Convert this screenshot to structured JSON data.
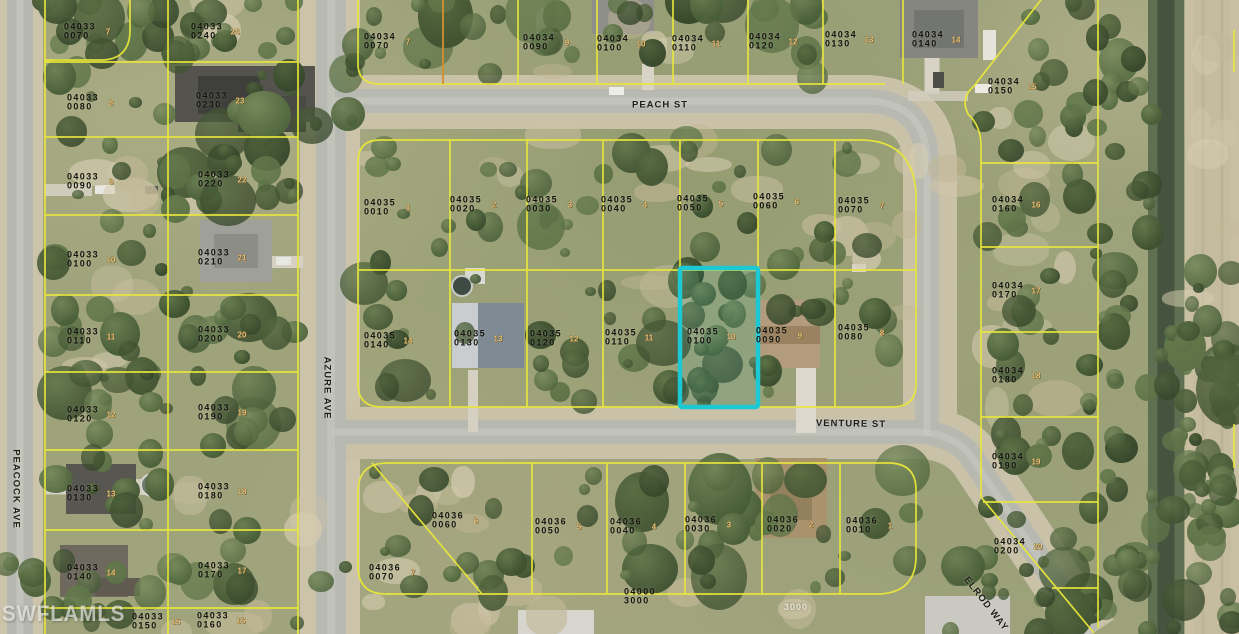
{
  "watermark": "SWFLAMLS",
  "colors": {
    "boundary": "#e9e73b",
    "boundary_alt": "#d78f2e",
    "highlight": "#1cc8d3",
    "parcel_text": "#14140c",
    "lot_text": "#ecc47e",
    "street_text": "#1f1f16"
  },
  "highlight": {
    "apn": "04035 0100",
    "x": 680,
    "y": 268,
    "w": 78,
    "h": 139
  },
  "streets": [
    {
      "name": "PEACH ST",
      "x": 660,
      "y": 105,
      "rotate": 0
    },
    {
      "name": "VENTURE ST",
      "x": 851,
      "y": 424,
      "rotate": 1
    },
    {
      "name": "AZURE AVE",
      "x": 327,
      "y": 388,
      "rotate": 90
    },
    {
      "name": "PEACOCK AVE",
      "x": 16,
      "y": 489,
      "rotate": 90
    },
    {
      "name": "ELROD WAY",
      "x": 986,
      "y": 604,
      "rotate": 52
    }
  ],
  "parcels": [
    {
      "apn": "04033 0070",
      "lot": "7",
      "x": 80,
      "y": 31
    },
    {
      "apn": "04033 0240",
      "lot": "24",
      "x": 207,
      "y": 31
    },
    {
      "apn": "04033 0080",
      "lot": "8",
      "x": 83,
      "y": 102
    },
    {
      "apn": "04033 0230",
      "lot": "23",
      "x": 212,
      "y": 100
    },
    {
      "apn": "04033 0090",
      "lot": "9",
      "x": 83,
      "y": 181
    },
    {
      "apn": "04033 0220",
      "lot": "22",
      "x": 214,
      "y": 179
    },
    {
      "apn": "04033 0100",
      "lot": "10",
      "x": 83,
      "y": 259
    },
    {
      "apn": "04033 0210",
      "lot": "21",
      "x": 214,
      "y": 257
    },
    {
      "apn": "04033 0110",
      "lot": "11",
      "x": 83,
      "y": 336
    },
    {
      "apn": "04033 0200",
      "lot": "20",
      "x": 214,
      "y": 334
    },
    {
      "apn": "04033 0120",
      "lot": "12",
      "x": 83,
      "y": 414
    },
    {
      "apn": "04033 0190",
      "lot": "19",
      "x": 214,
      "y": 412
    },
    {
      "apn": "04033 0130",
      "lot": "13",
      "x": 83,
      "y": 493
    },
    {
      "apn": "04033 0180",
      "lot": "18",
      "x": 214,
      "y": 491
    },
    {
      "apn": "04033 0140",
      "lot": "14",
      "x": 83,
      "y": 572
    },
    {
      "apn": "04033 0170",
      "lot": "17",
      "x": 214,
      "y": 570
    },
    {
      "apn": "04033 0150",
      "lot": "15",
      "x": 148,
      "y": 621
    },
    {
      "apn": "04033 0160",
      "lot": "16",
      "x": 213,
      "y": 620
    },
    {
      "apn": "04034 0070",
      "lot": "7",
      "x": 380,
      "y": 41
    },
    {
      "apn": "04034 0090",
      "lot": "9",
      "x": 539,
      "y": 42
    },
    {
      "apn": "04034 0100",
      "lot": "10",
      "x": 613,
      "y": 43
    },
    {
      "apn": "04034 0110",
      "lot": "11",
      "x": 688,
      "y": 43
    },
    {
      "apn": "04034 0120",
      "lot": "12",
      "x": 765,
      "y": 41
    },
    {
      "apn": "04034 0130",
      "lot": "13",
      "x": 841,
      "y": 39
    },
    {
      "apn": "04034 0140",
      "lot": "14",
      "x": 928,
      "y": 39
    },
    {
      "apn": "04034 0150",
      "lot": "15",
      "x": 1004,
      "y": 86
    },
    {
      "apn": "04034 0160",
      "lot": "16",
      "x": 1008,
      "y": 204
    },
    {
      "apn": "04034 0170",
      "lot": "17",
      "x": 1008,
      "y": 290
    },
    {
      "apn": "04034 0180",
      "lot": "18",
      "x": 1008,
      "y": 375
    },
    {
      "apn": "04034 0190",
      "lot": "19",
      "x": 1008,
      "y": 461
    },
    {
      "apn": "04034 0200",
      "lot": "20",
      "x": 1010,
      "y": 546
    },
    {
      "apn": "04035 0010",
      "lot": "1",
      "x": 380,
      "y": 207
    },
    {
      "apn": "04035 0020",
      "lot": "2",
      "x": 466,
      "y": 204
    },
    {
      "apn": "04035 0030",
      "lot": "3",
      "x": 542,
      "y": 204
    },
    {
      "apn": "04035 0040",
      "lot": "4",
      "x": 617,
      "y": 204
    },
    {
      "apn": "04035 0050",
      "lot": "5",
      "x": 693,
      "y": 203
    },
    {
      "apn": "04035 0060",
      "lot": "6",
      "x": 769,
      "y": 201
    },
    {
      "apn": "04035 0070",
      "lot": "7",
      "x": 854,
      "y": 205
    },
    {
      "apn": "04035 0140",
      "lot": "14",
      "x": 380,
      "y": 340
    },
    {
      "apn": "04035 0130",
      "lot": "13",
      "x": 470,
      "y": 338
    },
    {
      "apn": "04035 0120",
      "lot": "12",
      "x": 546,
      "y": 338
    },
    {
      "apn": "04035 0110",
      "lot": "11",
      "x": 621,
      "y": 337
    },
    {
      "apn": "04035 0100",
      "lot": "10",
      "x": 703,
      "y": 336
    },
    {
      "apn": "04035 0090",
      "lot": "9",
      "x": 772,
      "y": 335
    },
    {
      "apn": "04035 0080",
      "lot": "8",
      "x": 854,
      "y": 332
    },
    {
      "apn": "04036 0070",
      "lot": "7",
      "x": 385,
      "y": 572
    },
    {
      "apn": "04036 0060",
      "lot": "6",
      "x": 448,
      "y": 520
    },
    {
      "apn": "04036 0050",
      "lot": "5",
      "x": 551,
      "y": 526
    },
    {
      "apn": "04036 0040",
      "lot": "4",
      "x": 626,
      "y": 526
    },
    {
      "apn": "04036 0030",
      "lot": "3",
      "x": 701,
      "y": 524
    },
    {
      "apn": "04036 0020",
      "lot": "2",
      "x": 783,
      "y": 524
    },
    {
      "apn": "04036 0010",
      "lot": "1",
      "x": 862,
      "y": 525
    },
    {
      "apn": "04000 3000",
      "lot": "",
      "x": 640,
      "y": 596
    }
  ],
  "misc_labels": [
    {
      "text": "3000",
      "x": 796,
      "y": 607
    }
  ]
}
